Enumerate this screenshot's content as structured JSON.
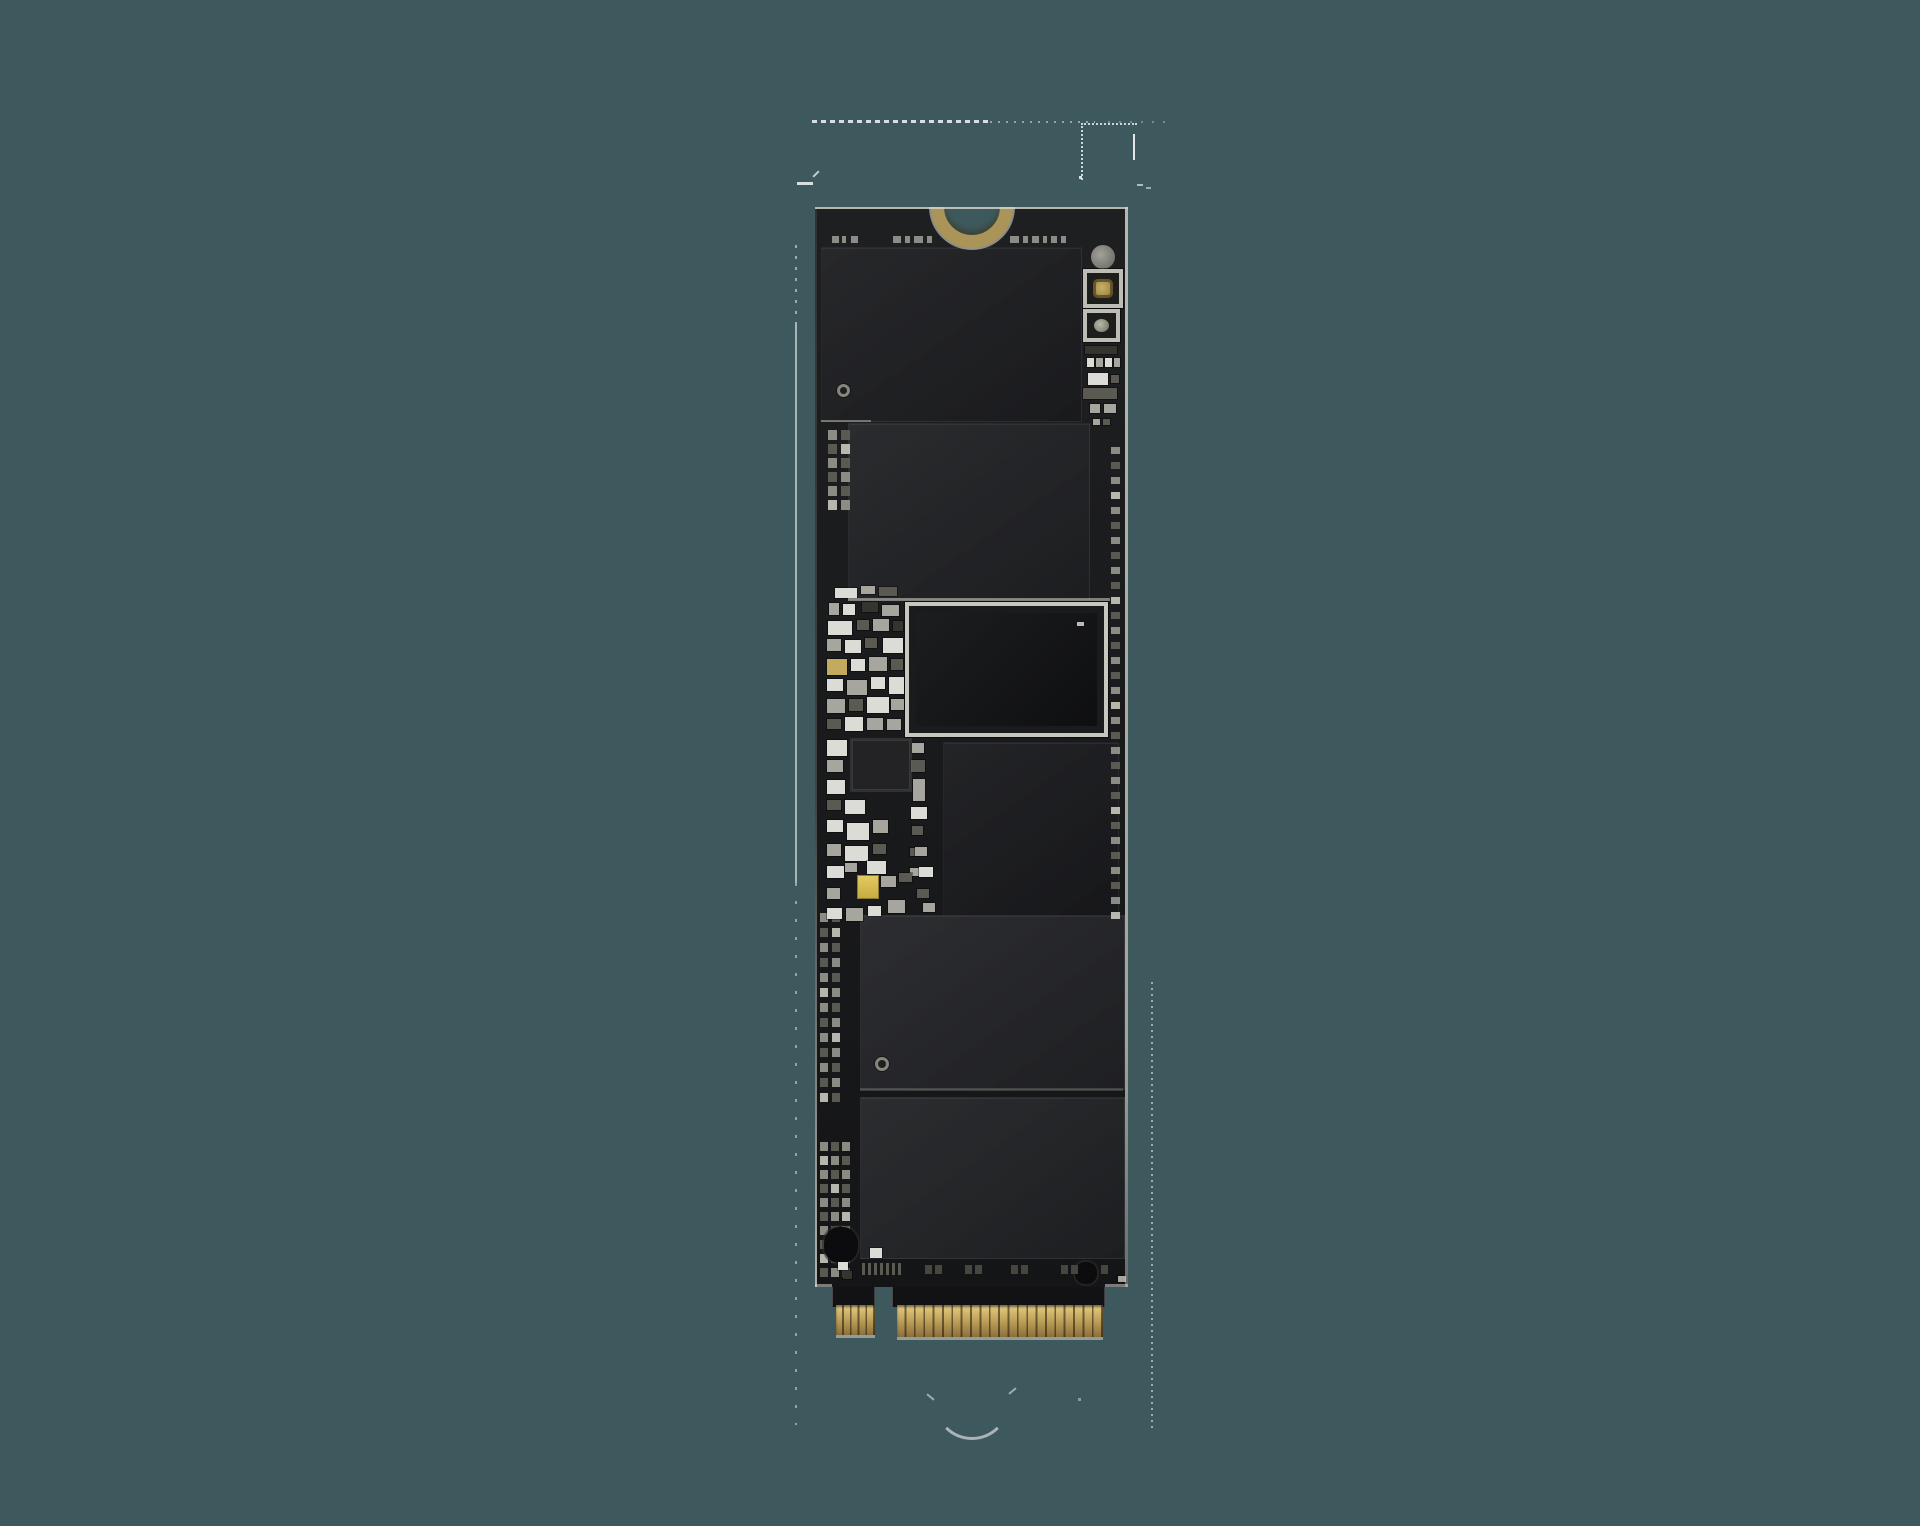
{
  "scene": {
    "subject": "bare M.2 NVMe SSD circuit board, component side, photographed vertically on a plain teal background",
    "background_color": "#3e595e"
  },
  "palette": {
    "pcb": "#17181a",
    "pcb_sheen_light": "rgba(255,255,255,0.03)",
    "edge_light": "#d2d2c9",
    "notch_ring": "#ab9458",
    "chip_border": "rgba(255,255,255,0.05)",
    "part_colors": {
      "W": "#dcdcd6",
      "G": "#a6a69e",
      "D": "#5a5a53",
      "K": "#35352f",
      "Au": "#c3aa5e"
    },
    "pad_colors": [
      "#96968e",
      "#5f5f58",
      "#c4c4bb"
    ],
    "gold_top": "#e6cd84",
    "gold_mid": "#c2a45c",
    "gold_deep": "#8a6f3c",
    "gold_separator": "rgba(30,22,6,0.55)",
    "tab_black": "#121214",
    "marks_color": "#a8a8a0",
    "artifact_color": "#ffffff"
  },
  "board": {
    "x": 815,
    "y": 207,
    "width": 313,
    "pcb_height": 1080,
    "notch": {
      "cx": 157,
      "inner_d": 56,
      "ring": 13
    },
    "top_marks": {
      "y": 29,
      "h": 7,
      "dashes": [
        [
          17,
          7
        ],
        [
          27,
          4
        ],
        [
          36,
          7
        ],
        [
          78,
          8
        ],
        [
          90,
          5
        ],
        [
          99,
          9
        ],
        [
          112,
          5
        ],
        [
          195,
          9
        ],
        [
          208,
          5
        ],
        [
          217,
          7
        ],
        [
          228,
          4
        ],
        [
          236,
          6
        ],
        [
          246,
          5
        ]
      ]
    },
    "chips": [
      {
        "name": "nand-chip-1",
        "x": 6,
        "y": 40,
        "w": 259,
        "h": 173,
        "color": "#1f2023"
      },
      {
        "name": "nand-chip-2",
        "x": 33,
        "y": 216,
        "w": 240,
        "h": 175,
        "color": "#222427"
      },
      {
        "name": "cache-chip",
        "x": 128,
        "y": 535,
        "w": 174,
        "h": 175,
        "color": "#1b1c1f"
      },
      {
        "name": "nand-chip-3",
        "x": 45,
        "y": 708,
        "w": 263,
        "h": 173,
        "color": "#25262a"
      },
      {
        "name": "nand-chip-4",
        "x": 45,
        "y": 890,
        "w": 263,
        "h": 160,
        "color": "#232528"
      }
    ],
    "controller": {
      "x": 90,
      "y": 395,
      "w": 203,
      "h": 135,
      "frame_color": "#c7c7bf",
      "body_color": "#1a1b1d",
      "die_color": "#131416",
      "die_inset": 11,
      "dot": {
        "x": 168,
        "y": 16,
        "w": 7,
        "h": 4,
        "color": "#d8d8d0"
      }
    },
    "right_column": {
      "circle": {
        "x": 276,
        "y": 38,
        "d": 24
      },
      "framed_squares": [
        {
          "x": 268,
          "y": 62,
          "w": 40,
          "h": 39,
          "core": "gold"
        },
        {
          "x": 268,
          "y": 102,
          "w": 37,
          "h": 33,
          "core": "metal"
        }
      ],
      "small_parts": [
        [
          270,
          139,
          32,
          8,
          "K"
        ],
        [
          272,
          151,
          7,
          9,
          "W"
        ],
        [
          281,
          151,
          7,
          9,
          "G"
        ],
        [
          290,
          151,
          7,
          9,
          "W"
        ],
        [
          299,
          151,
          6,
          9,
          "G"
        ],
        [
          273,
          166,
          20,
          12,
          "W"
        ],
        [
          296,
          168,
          8,
          8,
          "D"
        ],
        [
          268,
          181,
          34,
          11,
          "D"
        ],
        [
          275,
          197,
          10,
          9,
          "G"
        ],
        [
          289,
          197,
          12,
          9,
          "G"
        ],
        [
          278,
          212,
          7,
          6,
          "G"
        ],
        [
          288,
          212,
          7,
          6,
          "D"
        ]
      ]
    },
    "pad_grids": [
      {
        "name": "pad-grid-upper-left",
        "x": 13,
        "y": 223,
        "cols": 2,
        "rows": 6,
        "dx": 13,
        "dy": 14,
        "w": 9,
        "h": 10
      },
      {
        "name": "pad-column-right",
        "x": 296,
        "y": 240,
        "cols": 1,
        "rows": 32,
        "dx": 0,
        "dy": 15,
        "w": 9,
        "h": 7
      },
      {
        "name": "pad-grid-lower-left",
        "x": 5,
        "y": 706,
        "cols": 2,
        "rows": 13,
        "dx": 12,
        "dy": 15,
        "w": 8,
        "h": 9
      },
      {
        "name": "pad-grid-bottom-left",
        "x": 5,
        "y": 935,
        "cols": 3,
        "rows": 10,
        "dx": 11,
        "dy": 14,
        "w": 8,
        "h": 9
      }
    ],
    "smd_parts": [
      [
        20,
        381,
        22,
        10,
        "W"
      ],
      [
        46,
        379,
        14,
        8,
        "G"
      ],
      [
        64,
        380,
        18,
        9,
        "D"
      ],
      [
        14,
        396,
        10,
        12,
        "G"
      ],
      [
        28,
        397,
        12,
        11,
        "W"
      ],
      [
        47,
        395,
        16,
        10,
        "K"
      ],
      [
        67,
        398,
        17,
        11,
        "G"
      ],
      [
        13,
        414,
        24,
        14,
        "W"
      ],
      [
        42,
        413,
        12,
        10,
        "D"
      ],
      [
        58,
        412,
        16,
        12,
        "G"
      ],
      [
        78,
        414,
        10,
        10,
        "K"
      ],
      [
        12,
        432,
        14,
        12,
        "G"
      ],
      [
        30,
        433,
        16,
        13,
        "W"
      ],
      [
        50,
        431,
        12,
        10,
        "D"
      ],
      [
        68,
        431,
        20,
        15,
        "W"
      ],
      [
        12,
        452,
        20,
        16,
        "Au"
      ],
      [
        36,
        452,
        14,
        12,
        "W"
      ],
      [
        54,
        450,
        18,
        14,
        "G"
      ],
      [
        76,
        452,
        12,
        11,
        "D"
      ],
      [
        12,
        472,
        16,
        12,
        "W"
      ],
      [
        32,
        473,
        20,
        15,
        "G"
      ],
      [
        56,
        470,
        14,
        12,
        "W"
      ],
      [
        74,
        470,
        15,
        17,
        "W"
      ],
      [
        12,
        492,
        18,
        14,
        "G"
      ],
      [
        34,
        492,
        14,
        12,
        "D"
      ],
      [
        52,
        490,
        22,
        16,
        "W"
      ],
      [
        76,
        492,
        13,
        11,
        "G"
      ],
      [
        12,
        512,
        14,
        10,
        "D"
      ],
      [
        30,
        510,
        18,
        14,
        "W"
      ],
      [
        52,
        511,
        16,
        12,
        "G"
      ],
      [
        72,
        512,
        14,
        11,
        "G"
      ],
      [
        12,
        533,
        20,
        16,
        "W"
      ],
      [
        12,
        553,
        16,
        12,
        "G"
      ],
      [
        12,
        573,
        18,
        14,
        "W"
      ],
      [
        97,
        536,
        12,
        10,
        "G"
      ],
      [
        96,
        553,
        14,
        12,
        "D"
      ],
      [
        98,
        572,
        12,
        22,
        "G"
      ],
      [
        12,
        593,
        14,
        10,
        "D"
      ],
      [
        30,
        593,
        20,
        14,
        "W"
      ],
      [
        96,
        600,
        16,
        12,
        "W"
      ],
      [
        12,
        613,
        16,
        12,
        "W"
      ],
      [
        32,
        616,
        22,
        17,
        "W"
      ],
      [
        58,
        613,
        15,
        13,
        "G"
      ],
      [
        97,
        619,
        11,
        9,
        "D"
      ],
      [
        12,
        637,
        14,
        12,
        "G"
      ],
      [
        30,
        639,
        23,
        15,
        "W"
      ],
      [
        58,
        637,
        13,
        10,
        "D"
      ],
      [
        95,
        641,
        10,
        8,
        "D"
      ],
      [
        12,
        659,
        17,
        12,
        "W"
      ],
      [
        30,
        656,
        12,
        9,
        "G"
      ],
      [
        52,
        654,
        19,
        13,
        "W"
      ],
      [
        95,
        661,
        10,
        8,
        "G"
      ],
      [
        66,
        669,
        15,
        11,
        "G"
      ],
      [
        84,
        666,
        13,
        9,
        "D"
      ],
      [
        12,
        681,
        13,
        11,
        "G"
      ],
      [
        100,
        640,
        12,
        9,
        "G"
      ],
      [
        104,
        660,
        14,
        10,
        "W"
      ],
      [
        102,
        682,
        12,
        9,
        "D"
      ],
      [
        108,
        696,
        12,
        9,
        "G"
      ],
      [
        12,
        701,
        15,
        11,
        "W"
      ],
      [
        31,
        701,
        17,
        13,
        "G"
      ],
      [
        53,
        699,
        13,
        10,
        "W"
      ],
      [
        73,
        693,
        17,
        13,
        "G"
      ]
    ],
    "ic_black": {
      "x": 37,
      "y": 533,
      "w": 56,
      "h": 48,
      "color": "#232326"
    },
    "yellow_part": {
      "x": 42,
      "y": 668,
      "w": 20,
      "h": 22,
      "color_top": "#e3cb62",
      "color_bottom": "#c7ab3f",
      "border": "#8d7c2f"
    },
    "blobs": [
      {
        "name": "dark-component-bottom-left",
        "x": 9,
        "y": 1020,
        "w": 34,
        "h": 36
      },
      {
        "name": "dark-component-bottom-right",
        "x": 260,
        "y": 1055,
        "w": 22,
        "h": 22
      }
    ],
    "fiducials": [
      {
        "x": 22,
        "y": 177,
        "d": 13
      },
      {
        "x": 60,
        "y": 850,
        "d": 14
      }
    ],
    "boundary_lines": [
      {
        "x": 6,
        "y": 213,
        "w": 50,
        "h": 2,
        "color": "rgba(210,210,200,0.45)"
      },
      {
        "x": 33,
        "y": 391,
        "w": 262,
        "h": 3,
        "color": "rgba(210,210,200,0.55)"
      },
      {
        "x": 45,
        "y": 881,
        "w": 263,
        "h": 3,
        "color": "rgba(190,190,180,0.22)"
      }
    ],
    "bottom_bars": {
      "y": 1056,
      "h": 12,
      "w": 3,
      "xs": [
        47,
        53,
        59,
        65,
        71,
        77,
        83
      ],
      "color": "#5a5a52"
    },
    "bottom_pads": {
      "y": 1058,
      "w": 7,
      "h": 9,
      "xs": [
        110,
        120,
        150,
        160,
        196,
        206,
        246,
        256,
        286
      ],
      "color": "#46463f"
    },
    "extra_parts": [
      [
        55,
        1041,
        12,
        10,
        "W"
      ],
      [
        23,
        1055,
        10,
        8,
        "W"
      ],
      [
        28,
        1064,
        9,
        8,
        "K"
      ],
      [
        303,
        1069,
        8,
        6,
        "G"
      ]
    ],
    "connector": {
      "tabs": [
        {
          "x": 17,
          "y": 1080,
          "w": 43,
          "h": 20
        },
        {
          "x": 77,
          "y": 1080,
          "w": 213,
          "h": 20
        }
      ],
      "gold_groups": [
        {
          "name": "edge-fingers-left",
          "x": 21,
          "y": 1098,
          "w": 39,
          "h": 30,
          "fingers": 5
        },
        {
          "name": "edge-fingers-right",
          "x": 82,
          "y": 1098,
          "w": 206,
          "h": 32,
          "fingers": 22
        }
      ],
      "under_strip_color": "#b9b9b0"
    }
  },
  "artifacts": [
    {
      "name": "dashed-line-top",
      "type": "dash-h",
      "x": 812,
      "y": 120,
      "w": 176,
      "h": 3,
      "opacity": 0.8,
      "dash": 5,
      "gap": 4
    },
    {
      "name": "dotted-line-top-2",
      "type": "dash-h",
      "x": 990,
      "y": 121,
      "w": 105,
      "h": 2,
      "opacity": 0.45,
      "dash": 2,
      "gap": 6
    },
    {
      "name": "dotted-line-top-3",
      "type": "dash-h",
      "x": 1108,
      "y": 121,
      "w": 60,
      "h": 2,
      "opacity": 0.3,
      "dash": 2,
      "gap": 9
    },
    {
      "name": "dotted-rect-top-right",
      "type": "rect-dotted",
      "x": 1081,
      "y": 123,
      "w": 54,
      "h": 55,
      "opacity": 0.75
    },
    {
      "name": "short-vline-top-right",
      "type": "solid-v",
      "x": 1133,
      "y": 134,
      "w": 2,
      "h": 26,
      "opacity": 0.85
    },
    {
      "name": "dot-rect-corner",
      "type": "dot",
      "x": 1079,
      "y": 176,
      "w": 3,
      "h": 3,
      "opacity": 0.8
    },
    {
      "name": "tick-right-1",
      "type": "dot",
      "x": 1137,
      "y": 184,
      "w": 6,
      "h": 2,
      "opacity": 0.6
    },
    {
      "name": "tick-right-2",
      "type": "dot",
      "x": 1146,
      "y": 187,
      "w": 5,
      "h": 2,
      "opacity": 0.5
    },
    {
      "name": "dash-left-top",
      "type": "dot",
      "x": 797,
      "y": 182,
      "w": 16,
      "h": 3,
      "opacity": 0.8
    },
    {
      "name": "slash-left-top",
      "type": "slash",
      "x": 812,
      "y": 173,
      "w": 8,
      "h": 2,
      "rot": -45,
      "opacity": 0.7
    },
    {
      "name": "vline-dotted-upper",
      "type": "dots-v",
      "x": 795,
      "y": 245,
      "w": 2,
      "h": 78,
      "opacity": 0.5,
      "dash": 3,
      "gap": 8
    },
    {
      "name": "vline-solid-left",
      "type": "solid-v",
      "x": 795,
      "y": 323,
      "w": 2,
      "h": 560,
      "opacity": 0.55
    },
    {
      "name": "vline-dotted-lower",
      "type": "dots-v",
      "x": 795,
      "y": 883,
      "w": 2,
      "h": 542,
      "opacity": 0.45,
      "dash": 3,
      "gap": 15
    },
    {
      "name": "vline-dotted-right",
      "type": "dots-v",
      "x": 1151,
      "y": 982,
      "w": 2,
      "h": 450,
      "opacity": 0.5,
      "dash": 2,
      "gap": 4
    },
    {
      "name": "arc-bottom-center",
      "type": "arc",
      "x": 934,
      "y": 1364,
      "w": 76,
      "h": 76,
      "opacity": 0.55
    },
    {
      "name": "arc-tick-left",
      "type": "slash",
      "x": 926,
      "y": 1396,
      "w": 9,
      "h": 2,
      "rot": 40,
      "opacity": 0.5
    },
    {
      "name": "arc-tick-right",
      "type": "slash",
      "x": 1008,
      "y": 1390,
      "w": 9,
      "h": 2,
      "rot": -40,
      "opacity": 0.5
    },
    {
      "name": "arc-dot-right",
      "type": "dot",
      "x": 1078,
      "y": 1398,
      "w": 3,
      "h": 3,
      "opacity": 0.4
    }
  ]
}
